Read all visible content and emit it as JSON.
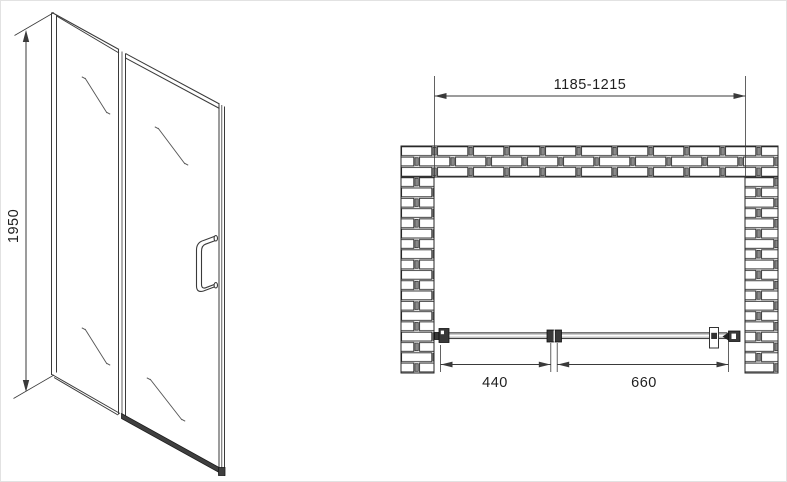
{
  "drawing": {
    "title": "shower-door-technical-drawing",
    "front_view": {
      "height_label": "1950"
    },
    "plan_view": {
      "width_range_label": "1185-1215",
      "fixed_panel_width_label": "440",
      "door_width_label": "660"
    }
  },
  "colors": {
    "background": "#ffffff",
    "line": "#3a3a3a",
    "dark_hardware": "#383838",
    "glass_gray": "#c4c4c4",
    "mortar_joint": "#8a8a8a"
  }
}
